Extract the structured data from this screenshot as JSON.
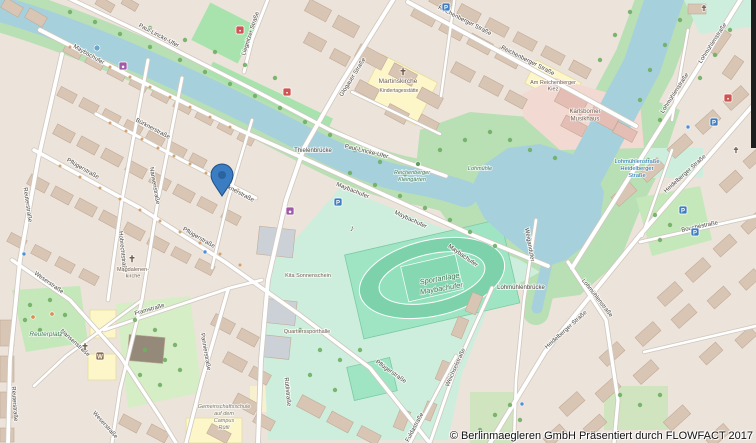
{
  "map": {
    "attribution": "© Berlinmaegleren GmbH Präsentiert durch FLOWFACT 2017",
    "marker": {
      "x": 222,
      "y": 196,
      "label": "property-location"
    },
    "street_labels": [
      {
        "text": "Maybachufer",
        "x": 88,
        "y": 56,
        "r": 30
      },
      {
        "text": "Maybachufer",
        "x": 352,
        "y": 192,
        "r": 22
      },
      {
        "text": "Maybachufer",
        "x": 410,
        "y": 221,
        "r": 25
      },
      {
        "text": "Maybachufer",
        "x": 462,
        "y": 257,
        "r": 35
      },
      {
        "text": "Paul-Lincke-Ufer",
        "x": 158,
        "y": 37,
        "r": 28
      },
      {
        "text": "Paul-Lincke-Ufer",
        "x": 366,
        "y": 153,
        "r": 14
      },
      {
        "text": "Bürknerstraße",
        "x": 152,
        "y": 130,
        "r": 28
      },
      {
        "text": "Bürknerstraße",
        "x": 236,
        "y": 193,
        "r": 28
      },
      {
        "text": "Pflügerstraße",
        "x": 82,
        "y": 170,
        "r": 30
      },
      {
        "text": "Pflügerstraße",
        "x": 198,
        "y": 239,
        "r": 30
      },
      {
        "text": "Pflügerstraße",
        "x": 390,
        "y": 373,
        "r": 35
      },
      {
        "text": "Weserstraße",
        "x": 48,
        "y": 284,
        "r": 35
      },
      {
        "text": "Weserstraße",
        "x": 104,
        "y": 426,
        "r": 48
      },
      {
        "text": "Reuterstraße",
        "x": 26,
        "y": 205,
        "r": 82
      },
      {
        "text": "Reuterstraße",
        "x": 13,
        "y": 404,
        "r": 86
      },
      {
        "text": "Hobrechtstraße",
        "x": 121,
        "y": 252,
        "r": 84
      },
      {
        "text": "Nansenstraße",
        "x": 153,
        "y": 186,
        "r": 80
      },
      {
        "text": "Nansenstraße",
        "x": 74,
        "y": 344,
        "r": 42
      },
      {
        "text": "Framstraße",
        "x": 150,
        "y": 311,
        "r": -16
      },
      {
        "text": "Pannierstraße",
        "x": 204,
        "y": 352,
        "r": 80
      },
      {
        "text": "Rütlistraße",
        "x": 286,
        "y": 392,
        "r": 84
      },
      {
        "text": "Weichselstraße",
        "x": 457,
        "y": 368,
        "r": -66
      },
      {
        "text": "Fuldastraße",
        "x": 416,
        "y": 428,
        "r": -62
      },
      {
        "text": "Glogauer Straße",
        "x": 354,
        "y": 78,
        "r": -58
      },
      {
        "text": "Reichenberger Straße",
        "x": 464,
        "y": 22,
        "r": 27
      },
      {
        "text": "Reichenberger Straße",
        "x": 527,
        "y": 62,
        "r": 27
      },
      {
        "text": "Liegnitzer Straße",
        "x": 252,
        "y": 34,
        "r": -72
      },
      {
        "text": "Lohmühlenstraße",
        "x": 676,
        "y": 94,
        "r": -57
      },
      {
        "text": "Lohmühlenstraße",
        "x": 714,
        "y": 44,
        "r": -57
      },
      {
        "text": "Lohmühlenstraße",
        "x": 596,
        "y": 299,
        "r": 52
      },
      {
        "text": "Heidelberger Straße",
        "x": 686,
        "y": 175,
        "r": -42
      },
      {
        "text": "Heidelberger Straße",
        "x": 567,
        "y": 331,
        "r": -42
      },
      {
        "text": "Bouchéstraße",
        "x": 700,
        "y": 228,
        "r": -12
      },
      {
        "text": "Weigandufer",
        "x": 528,
        "y": 245,
        "r": 80
      },
      {
        "text": "Thielenbrücke",
        "x": 313,
        "y": 152,
        "r": 0
      },
      {
        "text": "Lohmühlenbrücke",
        "x": 521,
        "y": 289,
        "r": 0
      }
    ],
    "place_labels": [
      {
        "lines": [
          "Sportanlage",
          "Maybachufer"
        ],
        "x": 440,
        "y": 281,
        "cls": "park",
        "s": 7.5,
        "lh": 10,
        "r": -10
      },
      {
        "lines": [
          "Reuterplatz"
        ],
        "x": 46,
        "y": 336,
        "cls": "park",
        "s": 6.5,
        "lh": 8,
        "r": 0
      },
      {
        "lines": [
          "Reichenberger",
          "Kleingärten"
        ],
        "x": 412,
        "y": 174,
        "cls": "park",
        "s": 5.5,
        "lh": 7,
        "r": 0
      },
      {
        "lines": [
          "Lohmühle"
        ],
        "x": 480,
        "y": 170,
        "cls": "park",
        "s": 5.5,
        "lh": 7,
        "r": 0
      },
      {
        "lines": [
          "Lohmühlenstraße",
          "Heidelberger",
          "Straße"
        ],
        "x": 637,
        "y": 163,
        "cls": "transit",
        "s": 5.8,
        "lh": 7,
        "r": 0
      },
      {
        "lines": [
          "Gemeinschaftsschule",
          "auf dem",
          "Campus",
          "Rütli"
        ],
        "x": 224,
        "y": 408,
        "cls": "school",
        "s": 5.5,
        "lh": 7,
        "r": 0
      },
      {
        "lines": [
          "Martinskirche"
        ],
        "x": 398,
        "y": 83,
        "cls": "poi",
        "s": 6.5,
        "lh": 8,
        "r": 0
      },
      {
        "lines": [
          "Magdalenen-",
          "kirche"
        ],
        "x": 133,
        "y": 271,
        "cls": "poi",
        "s": 5.5,
        "lh": 6.5,
        "r": 0
      },
      {
        "lines": [
          "Kita Sonnenschein"
        ],
        "x": 308,
        "y": 277,
        "cls": "poi",
        "s": 5.5,
        "lh": 7,
        "r": 0
      },
      {
        "lines": [
          "Quartierssporthalle"
        ],
        "x": 307,
        "y": 333,
        "cls": "poi",
        "s": 5.5,
        "lh": 7,
        "r": 0
      },
      {
        "lines": [
          "Kindertagesstätte"
        ],
        "x": 399,
        "y": 92,
        "cls": "poi",
        "s": 5,
        "lh": 6,
        "r": 0
      },
      {
        "lines": [
          "Am Reichenberger",
          "Kiez"
        ],
        "x": 553,
        "y": 84,
        "cls": "poi",
        "s": 5.5,
        "lh": 6.5,
        "r": 0
      },
      {
        "lines": [
          "Karlsborner",
          "Musikhaus"
        ],
        "x": 585,
        "y": 113,
        "cls": "poi",
        "s": 6,
        "lh": 7.5,
        "r": 0
      }
    ],
    "poi_icons": [
      {
        "name": "parking-icon",
        "kind": "badge",
        "glyph": "P",
        "bg": "#3d7dc0",
        "x": 338,
        "y": 202
      },
      {
        "name": "parking-icon",
        "kind": "badge",
        "glyph": "P",
        "bg": "#3d7dc0",
        "x": 446,
        "y": 7
      },
      {
        "name": "parking-icon",
        "kind": "badge",
        "glyph": "P",
        "bg": "#3d7dc0",
        "x": 683,
        "y": 210
      },
      {
        "name": "parking-icon",
        "kind": "badge",
        "glyph": "P",
        "bg": "#3d7dc0",
        "x": 695,
        "y": 232
      },
      {
        "name": "parking-icon",
        "kind": "badge",
        "glyph": "P",
        "bg": "#3d7dc0",
        "x": 714,
        "y": 122
      },
      {
        "name": "church-icon",
        "kind": "glyph",
        "glyph": "✝",
        "color": "#4a423a",
        "x": 403,
        "y": 75,
        "s": 9
      },
      {
        "name": "church-icon",
        "kind": "glyph",
        "glyph": "✝",
        "color": "#4a423a",
        "x": 132,
        "y": 262,
        "s": 9
      },
      {
        "name": "church-icon",
        "kind": "glyph",
        "glyph": "✝",
        "color": "#4a423a",
        "x": 85,
        "y": 350,
        "s": 9
      },
      {
        "name": "church-icon",
        "kind": "glyph",
        "glyph": "✝",
        "color": "#4a423a",
        "x": 736,
        "y": 153,
        "s": 8
      },
      {
        "name": "church-icon",
        "kind": "glyph",
        "glyph": "✝",
        "color": "#4a423a",
        "x": 704,
        "y": 11,
        "s": 8
      },
      {
        "name": "music-venue-icon",
        "kind": "glyph",
        "glyph": "♪",
        "color": "#7a5c3e",
        "x": 352,
        "y": 231,
        "s": 9
      },
      {
        "name": "shop-icon",
        "kind": "badge",
        "glyph": "●",
        "bg": "#a05ba8",
        "x": 123,
        "y": 66
      },
      {
        "name": "shop-icon",
        "kind": "badge",
        "glyph": "●",
        "bg": "#a05ba8",
        "x": 290,
        "y": 211
      },
      {
        "name": "amenity-icon",
        "kind": "badge",
        "glyph": "▪",
        "bg": "#cf5454",
        "x": 287,
        "y": 92
      },
      {
        "name": "amenity-icon",
        "kind": "badge",
        "glyph": "▪",
        "bg": "#cf5454",
        "x": 240,
        "y": 30
      },
      {
        "name": "amenity-icon",
        "kind": "badge",
        "glyph": "▪",
        "bg": "#cf5454",
        "x": 728,
        "y": 98
      },
      {
        "name": "landmark-icon",
        "kind": "badge",
        "glyph": "W",
        "bg": "#8a6d4a",
        "x": 100,
        "y": 356
      },
      {
        "name": "fountain-icon",
        "kind": "dot",
        "color": "#6fa7c9",
        "x": 97,
        "y": 48,
        "rr": 3
      },
      {
        "name": "playground-icon",
        "kind": "dot",
        "color": "#d98f4f",
        "x": 33,
        "y": 317,
        "rr": 2.2
      },
      {
        "name": "playground-icon",
        "kind": "dot",
        "color": "#d98f4f",
        "x": 52,
        "y": 314,
        "rr": 2.2
      },
      {
        "name": "garden-icon",
        "kind": "dot",
        "color": "#5ea05e",
        "x": 418,
        "y": 164,
        "rr": 2.5
      },
      {
        "name": "bus-stop-icon",
        "kind": "dot",
        "color": "#4a90d9",
        "x": 205,
        "y": 252,
        "rr": 2
      },
      {
        "name": "bus-stop-icon",
        "kind": "dot",
        "color": "#4a90d9",
        "x": 24,
        "y": 254,
        "rr": 2
      },
      {
        "name": "bus-stop-icon",
        "kind": "dot",
        "color": "#4a90d9",
        "x": 522,
        "y": 404,
        "rr": 2
      },
      {
        "name": "bus-stop-icon",
        "kind": "dot",
        "color": "#4a90d9",
        "x": 688,
        "y": 127,
        "rr": 2
      }
    ]
  },
  "colors": {
    "water": "#a6d1dc",
    "bank_green": "#b9dfb4",
    "park": "#c5e8bb",
    "sports_base": "#cdeedd",
    "pitch": "#9fe5c4",
    "residential": "#ece3da",
    "building": "#d8c5b4",
    "building_outline": "#c2ab97",
    "road_casing": "#cfc8bf",
    "road": "#ffffff",
    "marker": "#3a7dc2",
    "marker_border": "#1f4f85"
  }
}
